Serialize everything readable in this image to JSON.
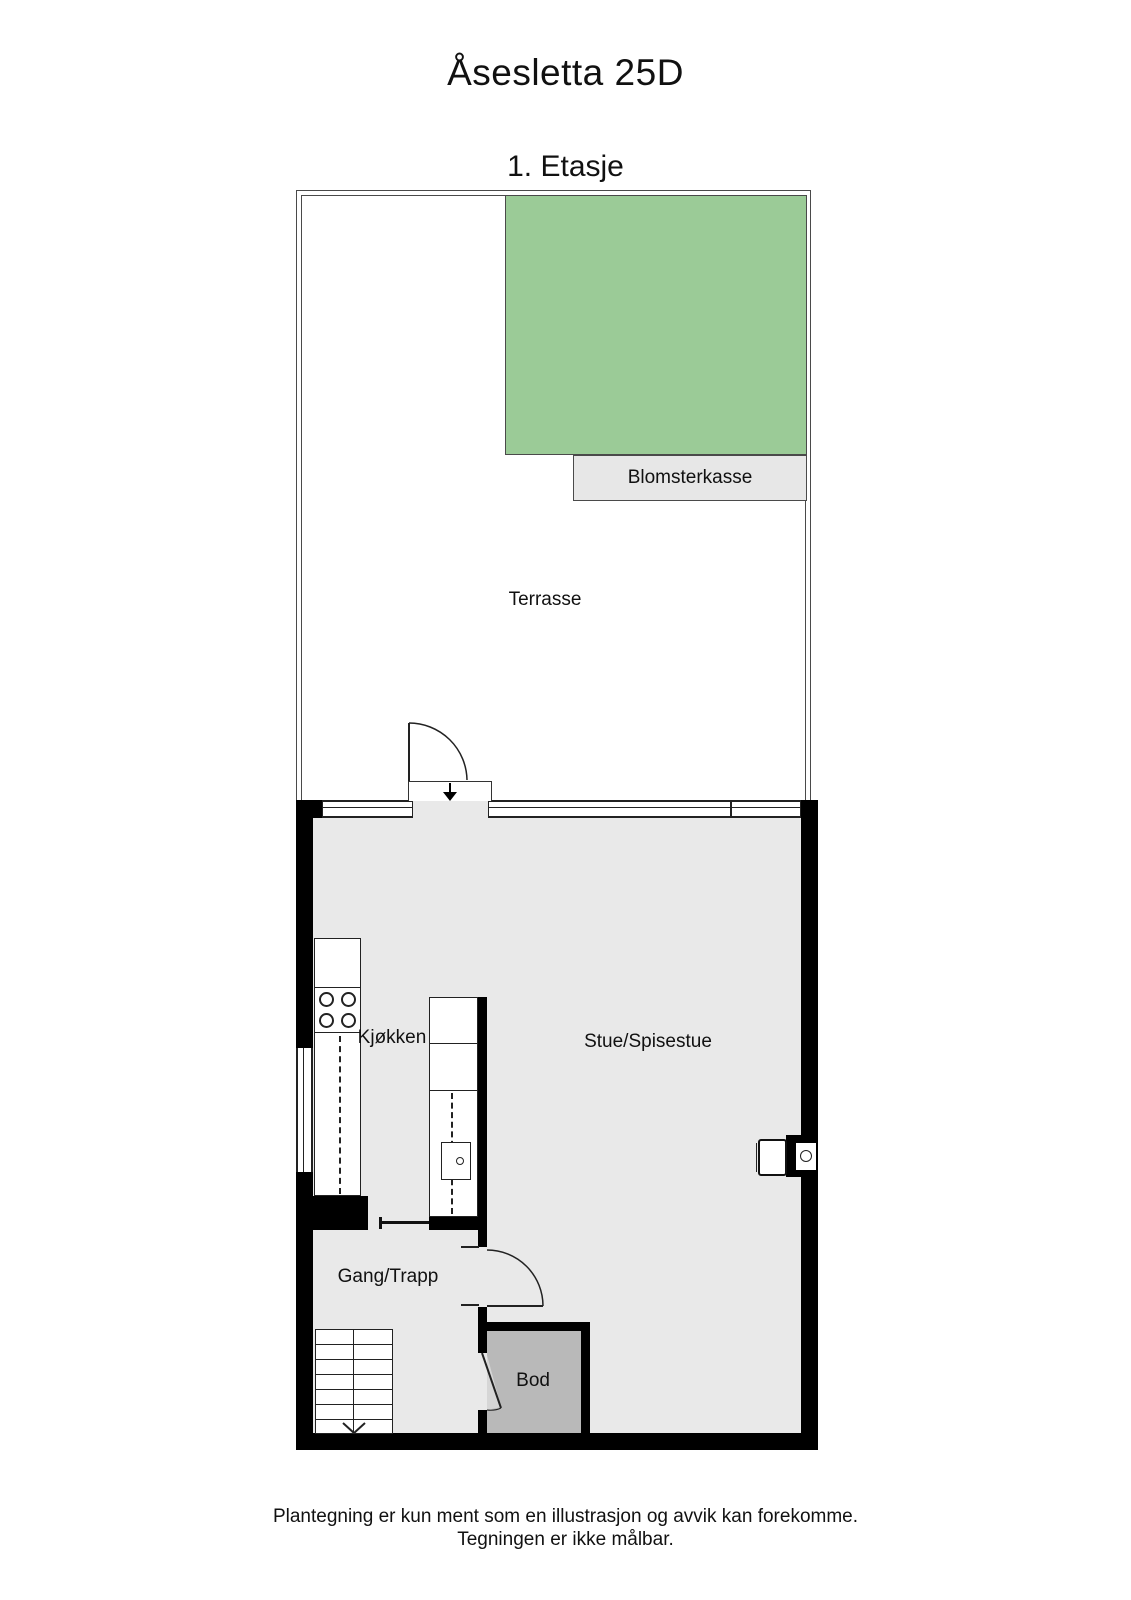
{
  "header": {
    "title": "Åsesletta 25D",
    "floor_label": "1. Etasje"
  },
  "rooms": {
    "terrace": "Terrasse",
    "flower_box": "Blomsterkasse",
    "kitchen": "Kjøkken",
    "living_dining": "Stue/Spisestue",
    "hallway_stairs": "Gang/Trapp",
    "storage": "Bod"
  },
  "footer": {
    "line1": "Plantegning er kun ment som en illustrasjon og avvik kan forekomme.",
    "line2": "Tegningen er ikke målbar."
  },
  "colors": {
    "background": "#ffffff",
    "wall": "#000000",
    "floor": "#e9e9e9",
    "storage_floor": "#b9b9b9",
    "green_area": "#9bcb97",
    "flower_box_fill": "#e7e7e7",
    "door_swing_fill": "#d6d6d6",
    "outline": "#4a4a4a"
  }
}
